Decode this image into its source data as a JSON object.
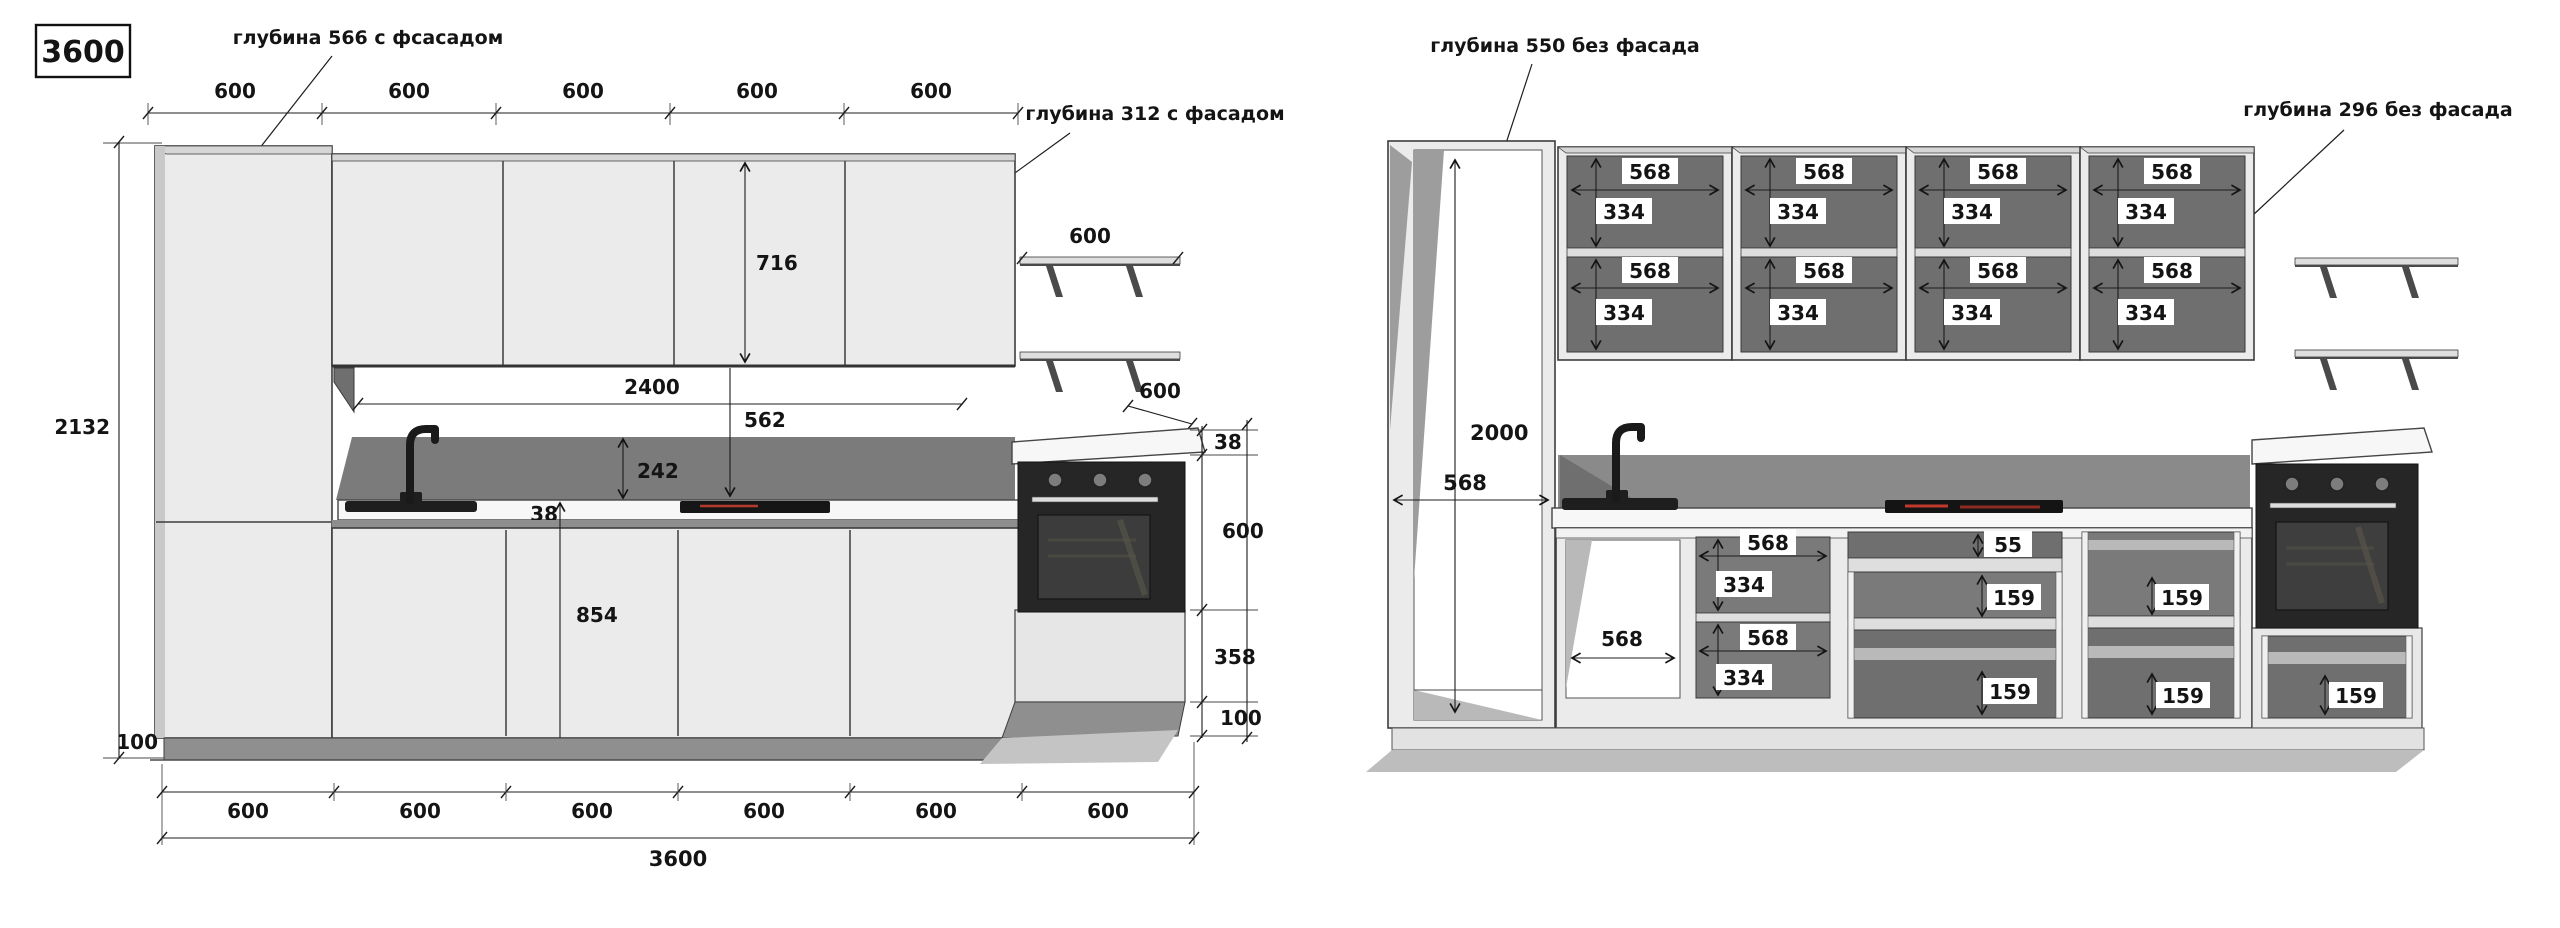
{
  "title_scale": "3600",
  "left_view": {
    "annotation_tall_depth": "глубина 566 с фсасадом",
    "annotation_upper_depth": "глубина 312 с фасадом",
    "top_dims": [
      "600",
      "600",
      "600",
      "600",
      "600"
    ],
    "height_total": "2132",
    "upper_cabinet_height": "716",
    "shelf_length": "600",
    "shelf_depth": "600",
    "splash_length": "2400",
    "hob_offset": "562",
    "splash_height": "242",
    "counter_thickness_left": "38",
    "base_height": "854",
    "plinth_height": "100",
    "right_dims": [
      "38",
      "600",
      "358",
      "100"
    ],
    "bottom_dims": [
      "600",
      "600",
      "600",
      "600",
      "600",
      "600"
    ],
    "length_total": "3600"
  },
  "right_view": {
    "annotation_tall_depth": "глубина 550 без фасада",
    "annotation_upper_depth": "глубина 296 без фасада",
    "tall_height": "2000",
    "tall_width": "568",
    "upper_compartment": {
      "width": "568",
      "height": "334"
    },
    "sink_cabinet_width": "568",
    "shelf_cabinet": {
      "width": "568",
      "height": "334"
    },
    "drawer_top_height": "55",
    "drawer_height": "159"
  }
}
